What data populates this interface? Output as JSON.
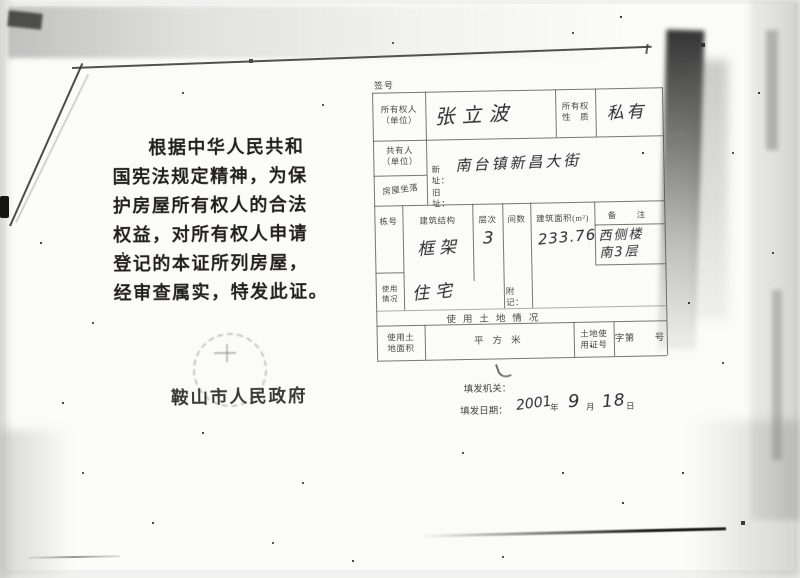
{
  "certificate": {
    "declaration_lines": [
      "根据中华人民共和",
      "国宪法规定精神，为保",
      "护房屋所有权人的合法",
      "权益，对所有权人申请",
      "登记的本证所列房屋，",
      "经审查属实，特发此证。"
    ],
    "issuer": "鞍山市人民政府",
    "form": {
      "serial_label": "签号",
      "owner": {
        "label": "所有权人\n（单位）",
        "value": "张立波"
      },
      "nature": {
        "label": "所有权\n性　质",
        "value": "私有"
      },
      "co_owner": {
        "label": "共有人\n（单位）"
      },
      "location": {
        "label": "房屋坐落",
        "new_label": "新址：",
        "new_value": "南台镇新昌大街",
        "old_label": "旧址："
      },
      "building": {
        "headers": {
          "no": "栋号",
          "structure": "建筑结构",
          "floors": "层次",
          "rooms": "间数",
          "area": "建筑面积(m²)",
          "remark": "备　注"
        },
        "values": {
          "structure": "框架",
          "floors": "3",
          "area": "233.76",
          "remark": "西侧楼\n南3层"
        }
      },
      "usage": {
        "label": "使用\n情况",
        "value": "住宅",
        "annex_label": "附记："
      },
      "land": {
        "title": "使用土地情况",
        "area_label": "使用土\n地面积",
        "unit": "平方米",
        "cert_label": "土地使\n用证号",
        "cert_value": "字第　　号"
      },
      "issue": {
        "org_label": "填发机关：",
        "date_label": "填发日期：",
        "year": "2001",
        "year_unit": "年",
        "month": "9",
        "month_unit": "月",
        "day": "18",
        "day_unit": "日"
      }
    }
  }
}
